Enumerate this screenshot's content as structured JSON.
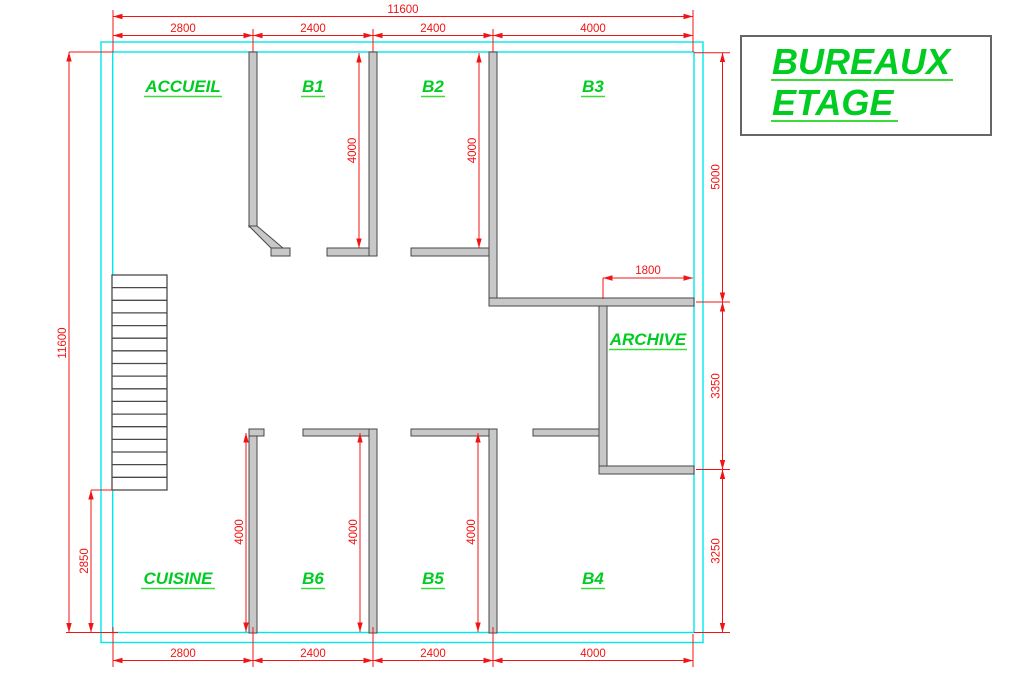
{
  "drawing": {
    "title_block": {
      "line1": "BUREAUX",
      "line2": "ETAGE"
    },
    "rooms": {
      "accueil": "ACCUEIL",
      "b1": "B1",
      "b2": "B2",
      "b3": "B3",
      "archive": "ARCHIVE",
      "cuisine": "CUISINE",
      "b6": "B6",
      "b5": "B5",
      "b4": "B4"
    },
    "dims": {
      "total_width": "11600",
      "total_height": "11600",
      "top": [
        "2800",
        "2400",
        "2400",
        "4000"
      ],
      "bottom": [
        "2800",
        "2400",
        "2400",
        "4000"
      ],
      "right": [
        "5000",
        "3350",
        "3250"
      ],
      "left_lower": "2850",
      "archive_width": "1800",
      "depths": {
        "b1": "4000",
        "b2": "4000",
        "cuisine_b6": "4000",
        "b6_b5": "4000",
        "b5_b4": "4000"
      }
    },
    "colors": {
      "dimension": "#f21414",
      "outer_wall": "#00e8e8",
      "label_green": "#00cc22",
      "underline_green": "#3adb3a",
      "wall_fill": "#c8c8c8",
      "wall_edge": "#474747"
    }
  }
}
